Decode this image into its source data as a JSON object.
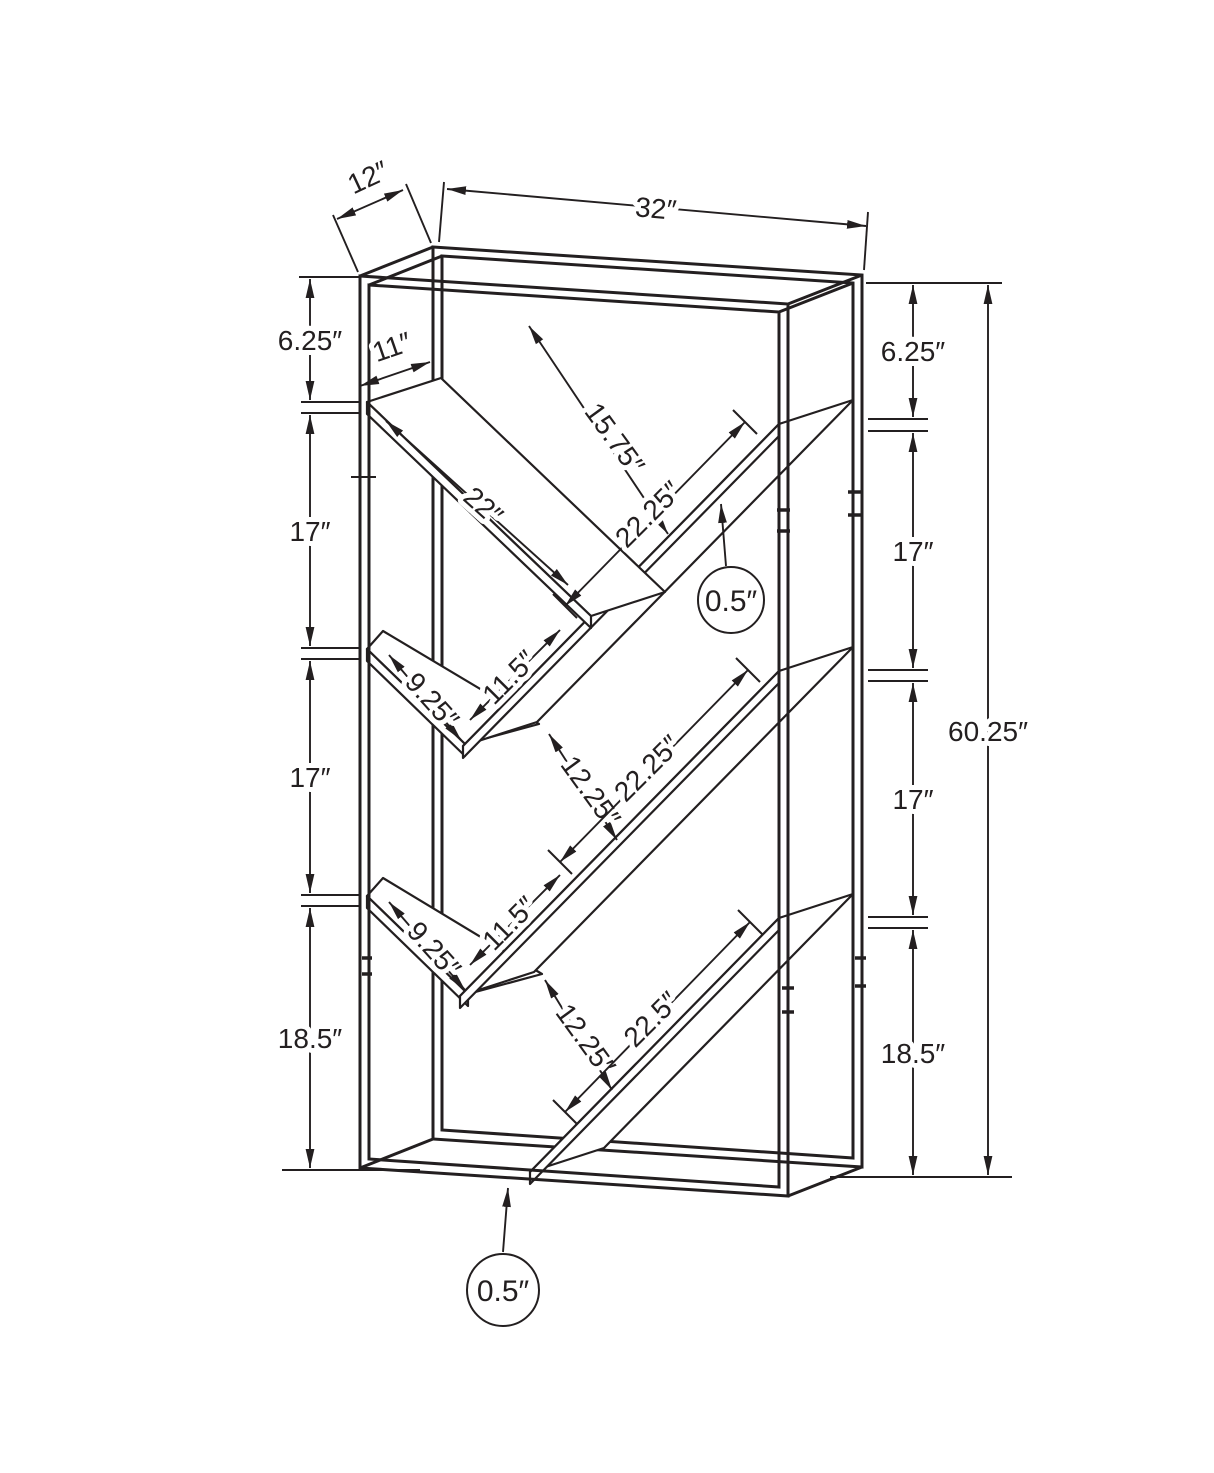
{
  "diagram": {
    "name": "bookcase-shelving-unit-dimension-drawing",
    "units": "inches",
    "line_color": "#231f20",
    "background_color": "#ffffff",
    "overall": {
      "width": "32″",
      "depth": "12″",
      "height": "60.25″"
    },
    "labels": {
      "depth": "12″",
      "width": "32″",
      "height": "60.25″",
      "left": {
        "top_gap": "6.25″",
        "bay2": "17″",
        "bay3": "17″",
        "bay4": "18.5″"
      },
      "right": {
        "top_gap": "6.25″",
        "bay2": "17″",
        "bay3": "17″",
        "bay4": "18.5″"
      },
      "v1": {
        "top_width": "11″",
        "length": "22″",
        "diag_clearance": "15.75″",
        "ascend_length": "22.25″",
        "overlap": "11.5″",
        "thickness": "0.5″"
      },
      "v2": {
        "top_width": "9.25″",
        "gap": "12.25″",
        "ascend_length": "22.25″",
        "overlap": "11.5″"
      },
      "v3": {
        "top_width": "9.25″",
        "gap": "12.25″",
        "ascend_length": "22.5″"
      },
      "base_thickness": "0.5″"
    }
  }
}
